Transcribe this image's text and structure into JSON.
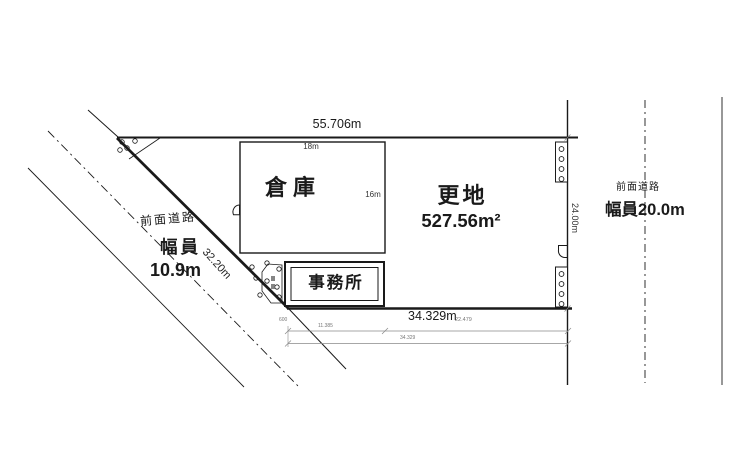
{
  "plan": {
    "site": {
      "north_dim": "55.706m",
      "south_dim": "34.329m",
      "east_dim": "24.00m",
      "west_dim": "32.20m",
      "land_label": "更地",
      "land_area": "527.56m²"
    },
    "buildings": {
      "warehouse": {
        "name": "倉庫",
        "width": "18m",
        "depth": "16m"
      },
      "office": {
        "name": "事務所"
      }
    },
    "roads": {
      "west": {
        "name": "前面道路",
        "width_label": "幅員",
        "width_value": "10.9m"
      },
      "east": {
        "name": "前面道路",
        "width_label": "幅員20.0m"
      }
    },
    "survey_dims": {
      "offset": "600",
      "seg1": "11.385",
      "seg2": "22.479",
      "total": "34.329"
    },
    "colors": {
      "ink": "#1a1a1a",
      "faint": "#8a8a8a",
      "background": "#ffffff"
    }
  }
}
